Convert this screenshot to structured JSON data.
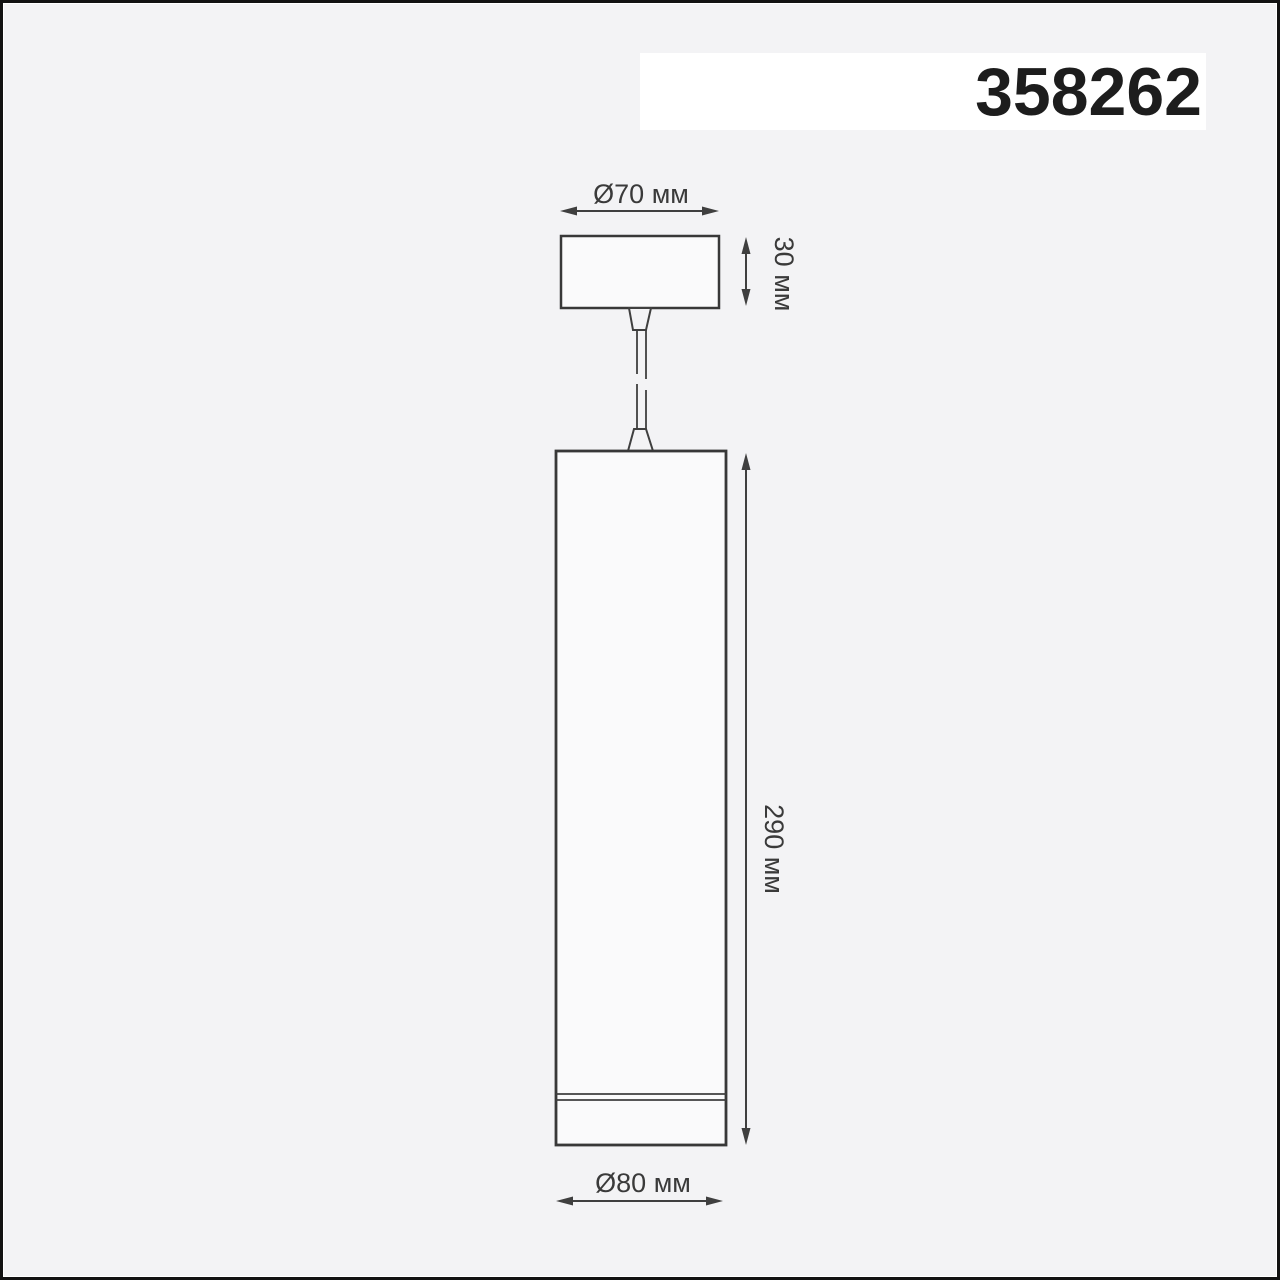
{
  "product": {
    "code": "358262"
  },
  "diagram": {
    "type": "technical-dimension-drawing",
    "subject": "pendant-lamp",
    "dimensions": [
      {
        "id": "canopy-diameter",
        "label": "Ø70 мм",
        "value_mm": 70,
        "orientation": "horizontal"
      },
      {
        "id": "canopy-height",
        "label": "30 мм",
        "value_mm": 30,
        "orientation": "vertical"
      },
      {
        "id": "body-height",
        "label": "290 мм",
        "value_mm": 290,
        "orientation": "vertical"
      },
      {
        "id": "body-diameter",
        "label": "Ø80 мм",
        "value_mm": 80,
        "orientation": "horizontal"
      }
    ],
    "parts": [
      "ceiling-canopy",
      "cord-grip-upper",
      "suspension-cable-with-break",
      "cord-grip-lower",
      "cylindrical-lamp-body",
      "diffuser-seam-ring"
    ]
  },
  "colors": {
    "background": "#f3f3f5",
    "frame_border": "#121212",
    "code_strip_background": "#ffffff",
    "code_text": "#1d1d1d",
    "drawing_line": "#3b3b3b",
    "label_text": "#3a3a3a",
    "shape_fill": "#fafafb"
  }
}
